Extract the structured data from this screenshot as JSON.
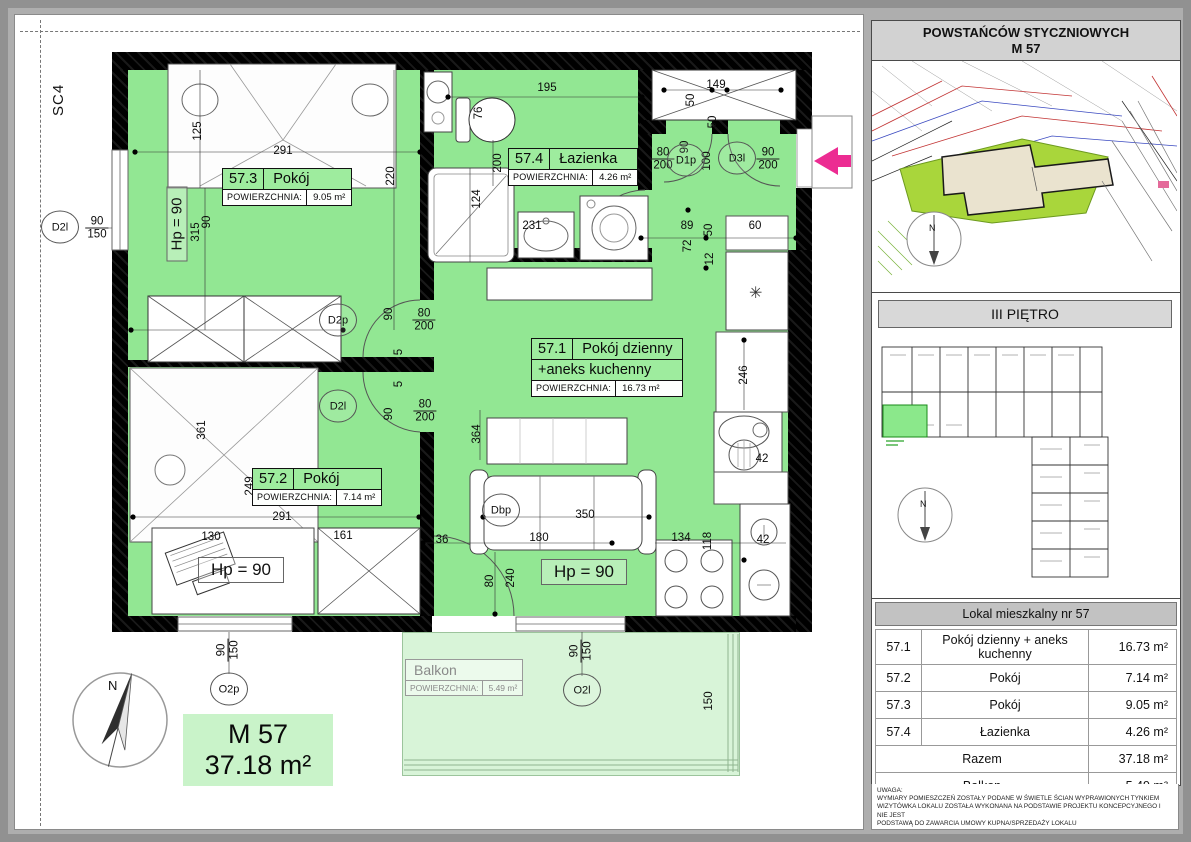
{
  "page": {
    "sheet_code": "SC4",
    "apartment": {
      "code": "M 57",
      "area": "37.18 m²"
    },
    "compass_label": "N"
  },
  "plan": {
    "fridge_icon": "✳",
    "rooms": [
      {
        "id": "57.3",
        "name": "Pokój",
        "area_label": "POWIERZCHNIA:",
        "area": "9.05 m²",
        "x": 222,
        "y": 168
      },
      {
        "id": "57.4",
        "name": "Łazienka",
        "area_label": "POWIERZCHNIA:",
        "area": "4.26 m²",
        "x": 508,
        "y": 148
      },
      {
        "id": "57.1",
        "name": "Pokój dzienny",
        "name2": "+aneks kuchenny",
        "area_label": "POWIERZCHNIA:",
        "area": "16.73 m²",
        "x": 531,
        "y": 338
      },
      {
        "id": "57.2",
        "name": "Pokój",
        "area_label": "POWIERZCHNIA:",
        "area": "7.14 m²",
        "x": 252,
        "y": 468
      }
    ],
    "balcony": {
      "name": "Balkon",
      "area_label": "POWIERZCHNIA:",
      "area": "5.49 m²"
    },
    "hp_labels": [
      {
        "t": "Hp = 90",
        "x": 177,
        "y": 224,
        "v": 1
      },
      {
        "t": "Hp = 90",
        "x": 241,
        "y": 570
      },
      {
        "t": "Hp = 90",
        "x": 584,
        "y": 572
      }
    ],
    "openings": [
      {
        "t": "D2l",
        "x": 60,
        "y": 227
      },
      {
        "t": "D2p",
        "x": 338,
        "y": 320
      },
      {
        "t": "D2l",
        "x": 338,
        "y": 406
      },
      {
        "t": "Dbp",
        "x": 501,
        "y": 510
      },
      {
        "t": "D1p",
        "x": 686,
        "y": 160
      },
      {
        "t": "D3l",
        "x": 737,
        "y": 158
      },
      {
        "t": "O2p",
        "x": 229,
        "y": 689
      },
      {
        "t": "O2l",
        "x": 582,
        "y": 690
      }
    ],
    "dimensions": [
      {
        "t": "125",
        "x": 198,
        "y": 131,
        "v": 1
      },
      {
        "t": "291",
        "x": 283,
        "y": 151
      },
      {
        "t": "220",
        "x": 391,
        "y": 176,
        "v": 1
      },
      {
        "t": "195",
        "x": 547,
        "y": 88
      },
      {
        "t": "76",
        "x": 479,
        "y": 113,
        "v": 1
      },
      {
        "t": "149",
        "x": 716,
        "y": 85
      },
      {
        "t": "50",
        "x": 691,
        "y": 100,
        "v": 1
      },
      {
        "t": "50",
        "x": 713,
        "y": 122,
        "v": 1
      },
      {
        "t": "90/150",
        "x": 97,
        "y": 228,
        "f": 1
      },
      {
        "t": "90",
        "x": 207,
        "y": 222,
        "v": 1
      },
      {
        "t": "315",
        "x": 196,
        "y": 232,
        "v": 1
      },
      {
        "t": "200",
        "x": 498,
        "y": 163,
        "v": 1
      },
      {
        "t": "124",
        "x": 477,
        "y": 199,
        "v": 1
      },
      {
        "t": "231",
        "x": 532,
        "y": 226
      },
      {
        "t": "80/200",
        "x": 663,
        "y": 159,
        "f": 1
      },
      {
        "t": "90",
        "x": 685,
        "y": 147,
        "v": 1
      },
      {
        "t": "100",
        "x": 707,
        "y": 161,
        "v": 1
      },
      {
        "t": "90/200",
        "x": 768,
        "y": 159,
        "f": 1
      },
      {
        "t": "89",
        "x": 687,
        "y": 226
      },
      {
        "t": "72",
        "x": 688,
        "y": 246,
        "v": 1
      },
      {
        "t": "50",
        "x": 709,
        "y": 230,
        "v": 1
      },
      {
        "t": "12",
        "x": 710,
        "y": 259,
        "v": 1
      },
      {
        "t": "60",
        "x": 755,
        "y": 226
      },
      {
        "t": "246",
        "x": 744,
        "y": 375,
        "v": 1
      },
      {
        "t": "364",
        "x": 477,
        "y": 434,
        "v": 1
      },
      {
        "t": "90",
        "x": 389,
        "y": 314,
        "v": 1
      },
      {
        "t": "80/200",
        "x": 424,
        "y": 320,
        "f": 1
      },
      {
        "t": "5",
        "x": 399,
        "y": 352,
        "v": 1
      },
      {
        "t": "5",
        "x": 399,
        "y": 384,
        "v": 1
      },
      {
        "t": "90",
        "x": 389,
        "y": 414,
        "v": 1
      },
      {
        "t": "80/200",
        "x": 425,
        "y": 411,
        "f": 1
      },
      {
        "t": "361",
        "x": 202,
        "y": 430,
        "v": 1
      },
      {
        "t": "249",
        "x": 250,
        "y": 486,
        "v": 1
      },
      {
        "t": "291",
        "x": 282,
        "y": 517
      },
      {
        "t": "130",
        "x": 211,
        "y": 537
      },
      {
        "t": "161",
        "x": 343,
        "y": 536
      },
      {
        "t": "36",
        "x": 442,
        "y": 540
      },
      {
        "t": "180",
        "x": 539,
        "y": 538
      },
      {
        "t": "350",
        "x": 585,
        "y": 515
      },
      {
        "t": "134",
        "x": 681,
        "y": 538
      },
      {
        "t": "118",
        "x": 708,
        "y": 541,
        "v": 1
      },
      {
        "t": "42",
        "x": 762,
        "y": 459
      },
      {
        "t": "42",
        "x": 763,
        "y": 540
      },
      {
        "t": "80",
        "x": 490,
        "y": 581,
        "v": 1
      },
      {
        "t": "240",
        "x": 511,
        "y": 578,
        "v": 1
      },
      {
        "t": "90/150",
        "x": 228,
        "y": 650,
        "v": 1,
        "f": 1
      },
      {
        "t": "90/150",
        "x": 581,
        "y": 651,
        "v": 1,
        "f": 1
      },
      {
        "t": "150",
        "x": 709,
        "y": 701,
        "v": 1
      }
    ]
  },
  "sidebar": {
    "header": {
      "line1": "POWSTAŃCÓW STYCZNIOWYCH",
      "line2": "M 57"
    },
    "floor_label": "III PIĘTRO",
    "table": {
      "title": "Lokal mieszkalny nr 57",
      "rows": [
        {
          "id": "57.1",
          "name": "Pokój dzienny + aneks kuchenny",
          "area": "16.73 m²"
        },
        {
          "id": "57.2",
          "name": "Pokój",
          "area": "7.14 m²"
        },
        {
          "id": "57.3",
          "name": "Pokój",
          "area": "9.05 m²"
        },
        {
          "id": "57.4",
          "name": "Łazienka",
          "area": "4.26 m²"
        }
      ],
      "summary_rows": [
        {
          "name": "Razem",
          "area": "37.18 m²"
        },
        {
          "name": "Balkon",
          "area": "5.49 m²"
        }
      ]
    },
    "notes": {
      "title": "UWAGA:",
      "lines": [
        "WYMIARY POMIESZCZEŃ ZOSTAŁY PODANE W ŚWIETLE ŚCIAN WYPRAWIONYCH TYNKIEM",
        "WIZYTÓWKA LOKALU ZOSTAŁA WYKONANA NA PODSTAWIE PROJEKTU KONCEPCYJNEGO I  NIE JEST",
        "PODSTAWĄ DO ZAWARCIA UMOWY KUPNA/SPRZEDAŻY LOKALU"
      ]
    }
  }
}
